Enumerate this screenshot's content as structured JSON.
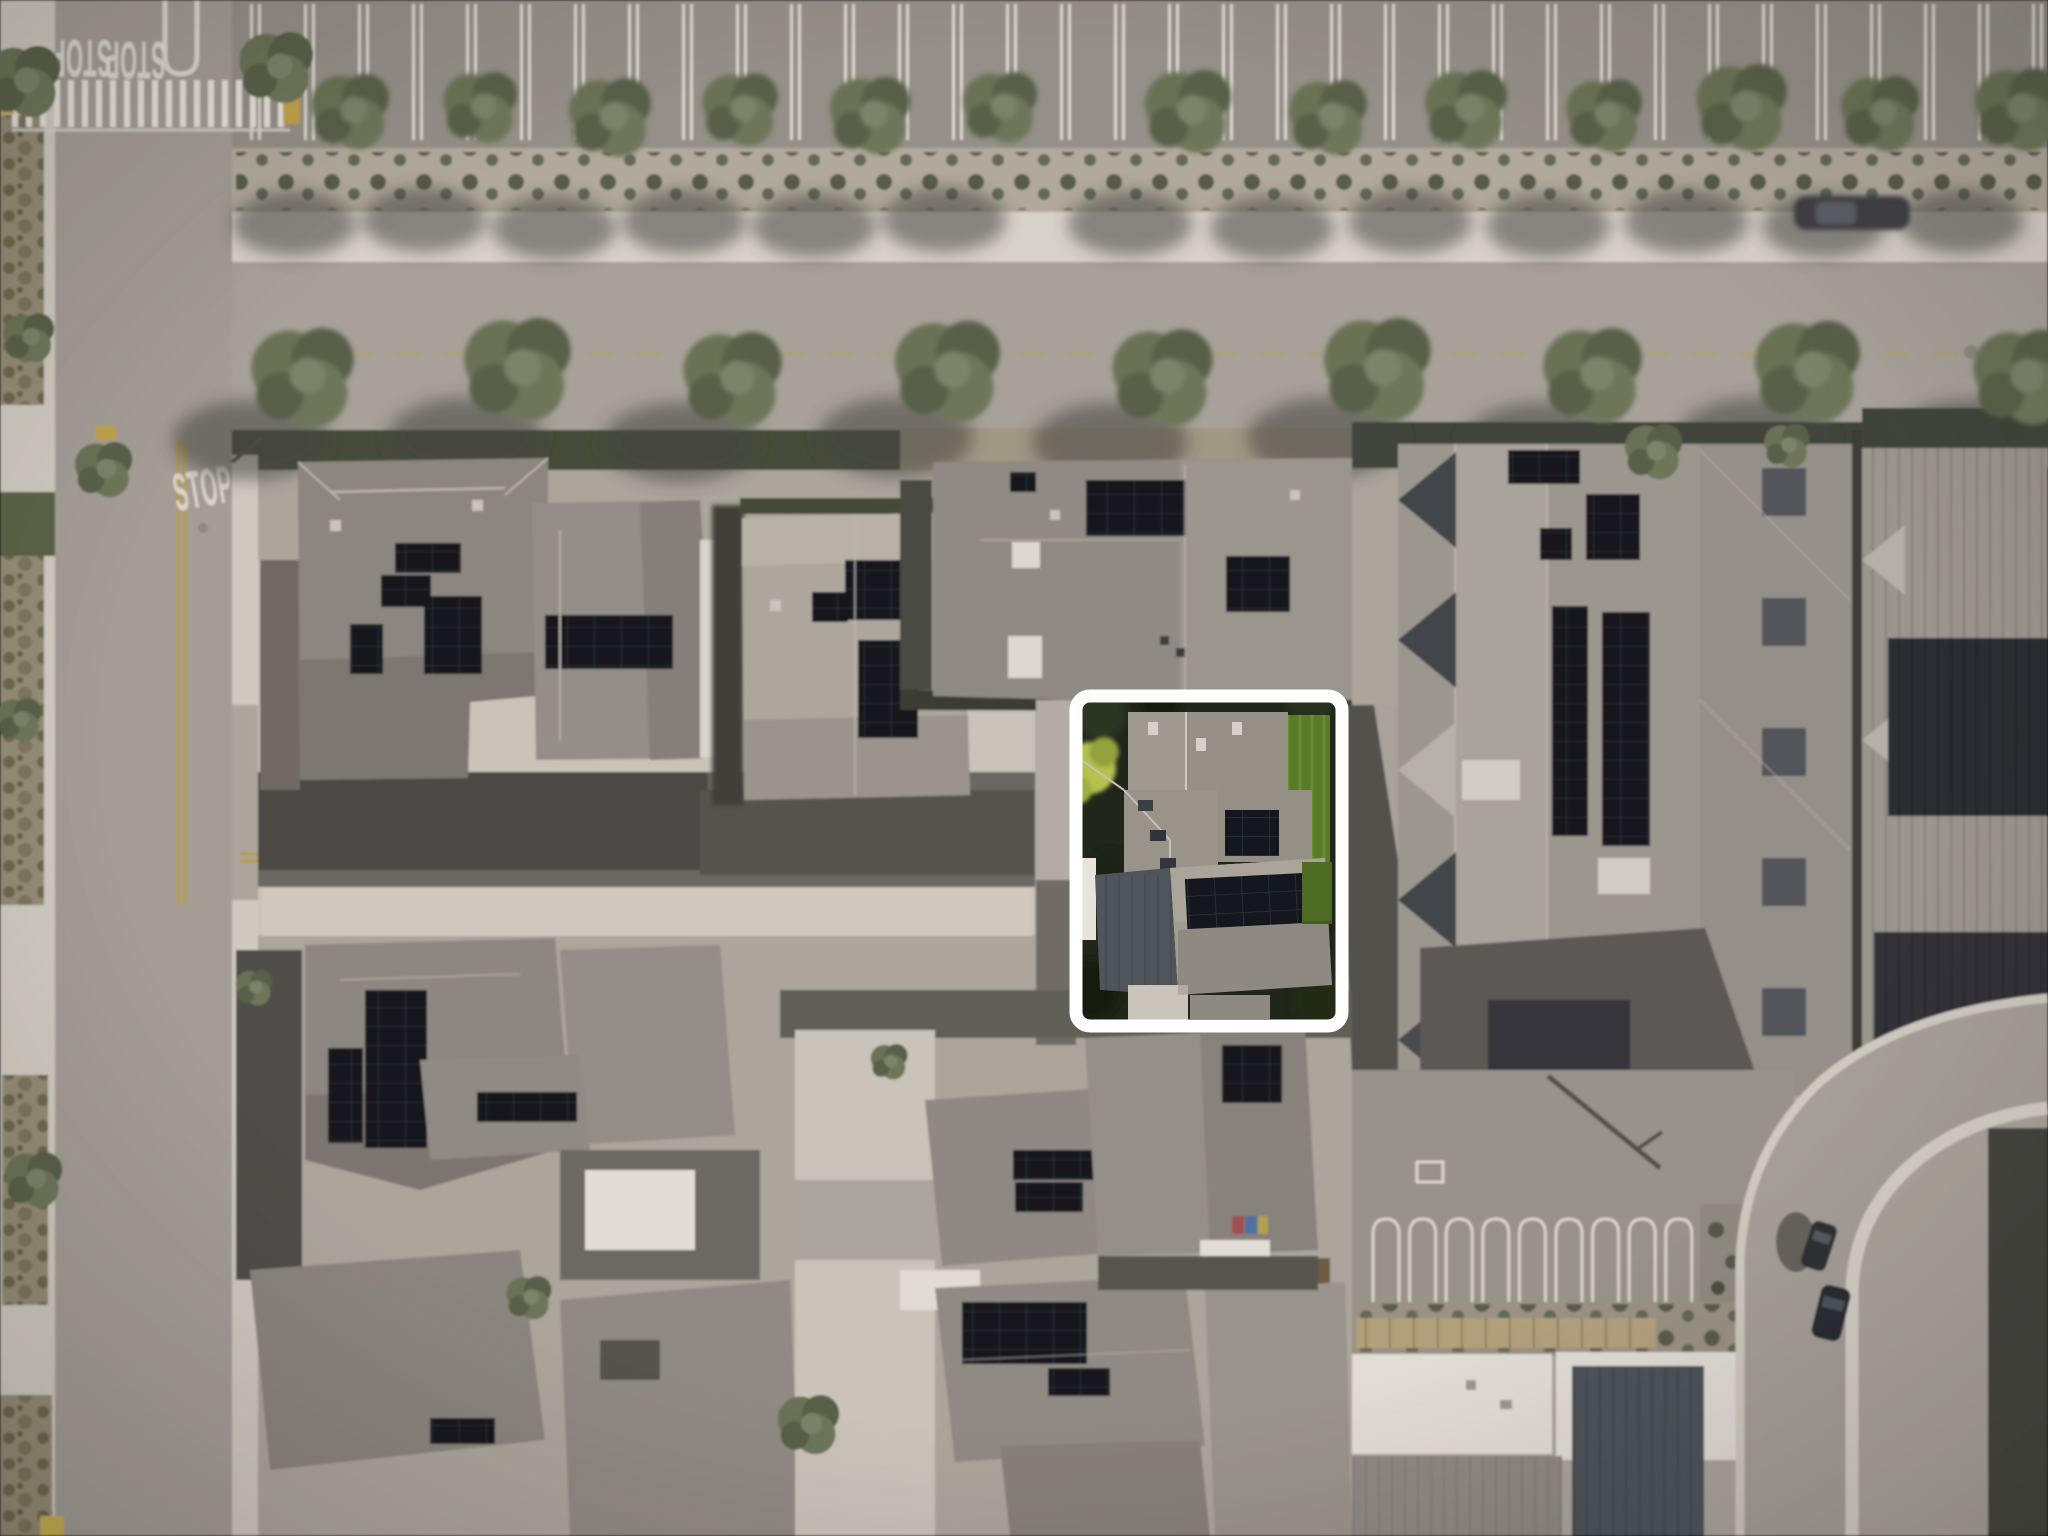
{
  "scene": {
    "type": "aerial-drone-photo",
    "description": "Overhead aerial photo of a residential neighborhood; surroundings desaturated, one property outlined with a white rounded rectangle"
  },
  "markings": {
    "stop1": "STOP",
    "stop2": "STOP",
    "stop3": "STOP",
    "stop4": "STOP"
  },
  "highlight": {
    "label": "highlighted-property",
    "x": 1076,
    "y": 696,
    "width": 266,
    "height": 330,
    "border_color": "#ffffff"
  },
  "colors": {
    "highlight_border": "#ffffff",
    "marking_white": "#e8e4dc",
    "marking_yellow": "#b59d4e",
    "lawn": "#5a7c28",
    "asphalt": "#a39d96",
    "concrete": "#d6d1c8",
    "roof_gray": "#938e87",
    "solar_panel": "#14181e",
    "tree_green": "#6a7254"
  }
}
